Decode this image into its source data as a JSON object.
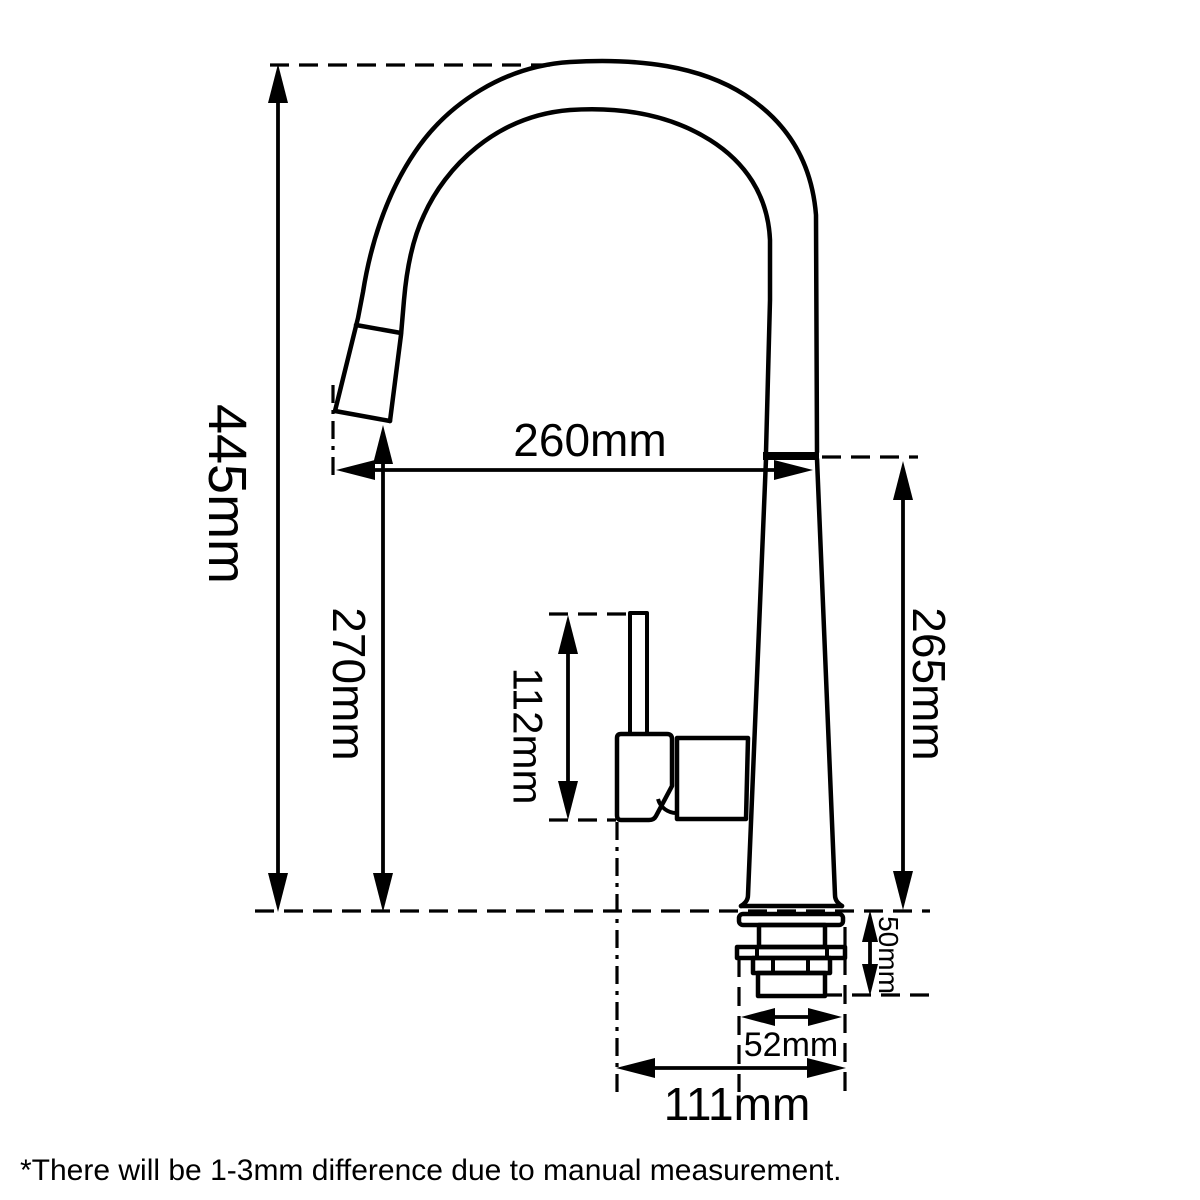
{
  "page": {
    "background": "#ffffff",
    "ink": "#000000"
  },
  "diagram": {
    "labels": {
      "overall_height": "445mm",
      "outlet_height": "270mm",
      "spout_reach": "260mm",
      "body_height": "265mm",
      "handle_height": "112mm",
      "shank_height": "50mm",
      "shank_width": "52mm",
      "base_clearance": "111mm"
    },
    "footnote": "*There will be 1-3mm difference due to manual measurement."
  }
}
